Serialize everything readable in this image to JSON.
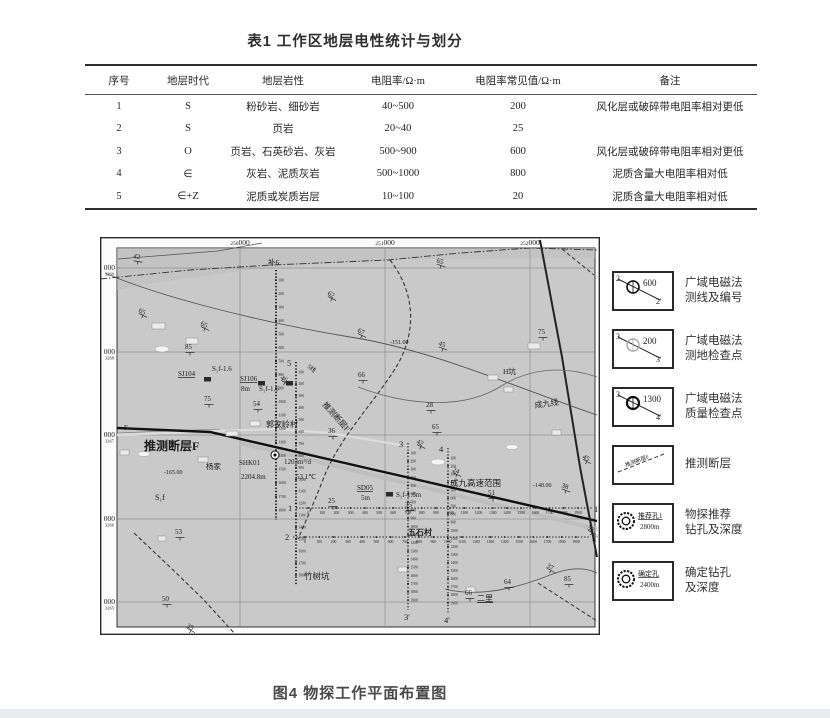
{
  "table": {
    "title": "表1 工作区地层电性统计与划分",
    "headers": [
      "序号",
      "地层时代",
      "地层岩性",
      "电阻率/Ω·m",
      "电阻率常见值/Ω·m",
      "备注"
    ],
    "col_widths": [
      68,
      70,
      120,
      110,
      130,
      174
    ],
    "rows": [
      [
        "1",
        "S",
        "粉砂岩、细砂岩",
        "40~500",
        "200",
        "风化层或破碎带电阻率相对更低"
      ],
      [
        "2",
        "S",
        "页岩",
        "20~40",
        "25",
        ""
      ],
      [
        "3",
        "O",
        "页岩、石英砂岩、灰岩",
        "500~900",
        "600",
        "风化层或破碎带电阻率相对更低"
      ],
      [
        "4",
        "∈",
        "灰岩、泥质灰岩",
        "500~1000",
        "800",
        "泥质含量大电阻率相对低"
      ],
      [
        "5",
        "∈+Z",
        "泥质或炭质岩层",
        "10~100",
        "20",
        "泥质含量大电阻率相对低"
      ]
    ]
  },
  "figure": {
    "caption": "图4 物探工作平面布置图",
    "map": {
      "bg": "#c9c9c9",
      "frame_color": "#2b2b2b",
      "eastings": [
        {
          "small": "250",
          "big": "000",
          "x": 140
        },
        {
          "small": "251",
          "big": "000",
          "x": 285
        },
        {
          "small": "252",
          "big": "000",
          "x": 430
        }
      ],
      "northings": [
        {
          "big": "000",
          "small": "3269",
          "y": 31
        },
        {
          "big": "000",
          "small": "3268",
          "y": 115
        },
        {
          "big": "000",
          "small": "3267",
          "y": 198
        },
        {
          "big": "000",
          "small": "3266",
          "y": 282
        },
        {
          "big": "000",
          "small": "3265",
          "y": 365
        }
      ],
      "polygons": [
        {
          "pts": "17,11 495,11 495,21 300,22 170,30 60,45 17,53",
          "f": "#bdbdbd",
          "o": 0.55
        }
      ],
      "paths": [
        {
          "d": "M140,206 L497,292",
          "w": 4,
          "c": "#bcbcbc",
          "o": 0.85
        },
        {
          "d": "M17,198 L120,194 L175,192 L230,196 L300,208",
          "w": 2.2,
          "c": "#dcdcdc"
        },
        {
          "d": "M17,196 L120,192",
          "w": 0.6,
          "c": "#777"
        },
        {
          "d": "M17,191 L110,195 L497,284",
          "w": 2.4,
          "c": "#111"
        },
        {
          "d": "M440,3 L462,120 L480,230 L497,320",
          "w": 2,
          "c": "#222"
        },
        {
          "d": "M5,36 C60,60 160,85 250,100 C330,112 420,152 497,178",
          "w": 0.9,
          "c": "#555"
        },
        {
          "d": "M18,22 L118,14 L162,6",
          "w": 0.8,
          "c": "#555"
        },
        {
          "d": "M0,42 L90,33 L172,28 L288,23 L360,16 L430,11 L497,13",
          "w": 0.9,
          "c": "#333",
          "da": "7 2 1.5 2"
        },
        {
          "d": "M290,23 C315,55 318,95 295,132 C272,168 240,200 224,240 C214,266 204,288 198,302",
          "w": 1.1,
          "c": "#333",
          "da": "4 2.5"
        },
        {
          "d": "M34,296 L70,330 L103,362 L135,397",
          "w": 1.1,
          "c": "#333",
          "da": "4 2.5"
        },
        {
          "d": "M462,12 L494,38",
          "w": 1,
          "c": "#333",
          "da": "4 2.5"
        },
        {
          "d": "M438,346 L497,384",
          "w": 1,
          "c": "#333",
          "da": "4 2.5"
        },
        {
          "d": "M258,150 C300,166 360,176 403,148 C430,132 462,128 497,140",
          "w": 0.8,
          "c": "#666"
        },
        {
          "d": "M345,352 C380,361 420,350 450,338 C470,330 485,330 497,336",
          "w": 0.9,
          "c": "#555"
        }
      ],
      "survey_lines": [
        {
          "dir": "v",
          "name": "",
          "name2": "",
          "x": 176,
          "y0": 33,
          "y1": 283,
          "stations": [
            100,
            1800,
            100
          ],
          "w": 1.8
        },
        {
          "dir": "v",
          "name": "5",
          "name2": "",
          "x": 196,
          "y0": 125,
          "y1": 348,
          "stations": [
            100,
            1800,
            100
          ],
          "w": 1.6
        },
        {
          "dir": "v",
          "name": "3",
          "name2": "3'",
          "x": 308,
          "y0": 206,
          "y1": 373,
          "stations": [
            100,
            1900,
            100
          ],
          "w": 1.1
        },
        {
          "dir": "v",
          "name": "4",
          "name2": "4'",
          "x": 348,
          "y0": 211,
          "y1": 376,
          "stations": [
            100,
            1900,
            100
          ],
          "w": 1.1
        },
        {
          "dir": "h",
          "name": "1",
          "name2": "1'",
          "y": 271,
          "x0": 196,
          "x1": 492,
          "stations": [
            0,
            1900,
            100
          ],
          "w": 1.1
        },
        {
          "dir": "h",
          "name": "2",
          "name2": "2'",
          "y": 300,
          "x0": 193,
          "x1": 490,
          "stations": [
            0,
            1900,
            100
          ],
          "w": 1.1
        }
      ],
      "labels": [
        {
          "t": "42",
          "x": 33,
          "y": 21,
          "dip": 1,
          "rot": 10
        },
        {
          "t": "65",
          "x": 38,
          "y": 75,
          "dip": 1,
          "rot": 25
        },
        {
          "t": "65",
          "x": 100,
          "y": 88,
          "dip": 1,
          "rot": 25
        },
        {
          "t": "85",
          "x": 85,
          "y": 112,
          "dip": 1,
          "rot": 0
        },
        {
          "t": "62",
          "x": 227,
          "y": 58,
          "dip": 1,
          "rot": 25
        },
        {
          "t": "补6",
          "x": 168,
          "y": 28,
          "s": 7.5
        },
        {
          "t": "65",
          "x": 336,
          "y": 25,
          "dip": 1,
          "rot": 20
        },
        {
          "t": "67",
          "x": 257,
          "y": 95,
          "dip": 1,
          "rot": 25
        },
        {
          "t": "-151.00",
          "x": 290,
          "y": 107,
          "s": 6
        },
        {
          "t": "45",
          "x": 338,
          "y": 108,
          "dip": 1,
          "rot": 20
        },
        {
          "t": "66",
          "x": 258,
          "y": 140,
          "dip": 1,
          "rot": 0
        },
        {
          "t": "28",
          "x": 326,
          "y": 170,
          "dip": 1,
          "rot": 0
        },
        {
          "t": "65",
          "x": 332,
          "y": 192,
          "dip": 1,
          "rot": 0
        },
        {
          "t": "36",
          "x": 228,
          "y": 196,
          "dip": 1,
          "rot": 0
        },
        {
          "t": "75",
          "x": 438,
          "y": 97,
          "dip": 1,
          "rot": 0
        },
        {
          "t": "H坑",
          "x": 403,
          "y": 137,
          "s": 7.5
        },
        {
          "t": "成九线",
          "x": 435,
          "y": 171,
          "s": 8,
          "rot": -8
        },
        {
          "t": "45",
          "x": 482,
          "y": 221,
          "dip": 1,
          "rot": 30
        },
        {
          "t": "SJ104",
          "x": 78,
          "y": 139,
          "u": 1
        },
        {
          "t": "S₁f-1.6",
          "x": 112,
          "y": 134
        },
        {
          "t": "SJ106",
          "x": 140,
          "y": 144,
          "u": 1
        },
        {
          "t": "8m",
          "x": 141,
          "y": 154
        },
        {
          "t": "S₁f-1.6",
          "x": 159,
          "y": 154
        },
        {
          "t": "46",
          "x": 180,
          "y": 142,
          "dip": 1,
          "rot": 30
        },
        {
          "t": "75",
          "x": 104,
          "y": 164,
          "dip": 1,
          "rot": 0
        },
        {
          "t": "54",
          "x": 153,
          "y": 169,
          "dip": 1,
          "rot": 0
        },
        {
          "t": "郭家岭村",
          "x": 166,
          "y": 190,
          "s": 8
        },
        {
          "t": "F",
          "x": 24,
          "y": 193,
          "s": 7
        },
        {
          "t": "推测断层F",
          "x": 44,
          "y": 213,
          "s": 12,
          "b": 1
        },
        {
          "t": "杨家",
          "x": 106,
          "y": 232,
          "s": 7.5
        },
        {
          "t": "SHK01",
          "x": 139,
          "y": 228
        },
        {
          "t": "1203m³/d",
          "x": 184,
          "y": 227
        },
        {
          "t": "2204.8m",
          "x": 141,
          "y": 242
        },
        {
          "t": "53.1℃",
          "x": 196,
          "y": 242
        },
        {
          "t": "-165.00",
          "x": 64,
          "y": 237,
          "s": 6
        },
        {
          "t": "S₁f",
          "x": 55,
          "y": 263,
          "s": 8
        },
        {
          "t": "53",
          "x": 75,
          "y": 297,
          "dip": 1,
          "rot": 0
        },
        {
          "t": "SD05",
          "x": 257,
          "y": 253,
          "u": 1
        },
        {
          "t": "5m",
          "x": 261,
          "y": 263
        },
        {
          "t": "S₁f-1.6m",
          "x": 296,
          "y": 260
        },
        {
          "t": "25",
          "x": 228,
          "y": 266,
          "dip": 1,
          "rot": 0
        },
        {
          "t": "35",
          "x": 305,
          "y": 270,
          "dip": 1,
          "rot": 0
        },
        {
          "t": "成九高速范围",
          "x": 350,
          "y": 249,
          "s": 8.5
        },
        {
          "t": "51",
          "x": 388,
          "y": 258,
          "dip": 1,
          "rot": 0
        },
        {
          "t": "-148.00",
          "x": 433,
          "y": 250,
          "s": 6
        },
        {
          "t": "38",
          "x": 461,
          "y": 250,
          "dip": 1,
          "rot": 20
        },
        {
          "t": "42",
          "x": 316,
          "y": 206,
          "dip": 1,
          "rot": 25
        },
        {
          "t": "24",
          "x": 352,
          "y": 234,
          "dip": 1,
          "rot": 25
        },
        {
          "t": "五石村",
          "x": 308,
          "y": 298,
          "s": 8,
          "b": 1
        },
        {
          "t": "竹树坑",
          "x": 204,
          "y": 342,
          "s": 8.5
        },
        {
          "t": "50",
          "x": 62,
          "y": 364,
          "dip": 1,
          "rot": 0
        },
        {
          "t": "35",
          "x": 86,
          "y": 390,
          "dip": 1,
          "rot": 30
        },
        {
          "t": "二里",
          "x": 377,
          "y": 364,
          "s": 8,
          "u": 1
        },
        {
          "t": "66",
          "x": 365,
          "y": 358,
          "dip": 1,
          "rot": 0
        },
        {
          "t": "64",
          "x": 404,
          "y": 347,
          "dip": 1,
          "rot": 0
        },
        {
          "t": "85",
          "x": 464,
          "y": 344,
          "dip": 1,
          "rot": 0
        },
        {
          "t": "37",
          "x": 446,
          "y": 330,
          "dip": 1,
          "rot": 30
        },
        {
          "t": "52",
          "x": 487,
          "y": 292,
          "dip": 1,
          "rot": 30
        },
        {
          "t": "5线",
          "x": 207,
          "y": 130,
          "s": 6,
          "rot": 40
        },
        {
          "t": "推测断层F",
          "x": 222,
          "y": 168,
          "s": 8,
          "rot": 48
        }
      ],
      "squares": [
        [
          104,
          140
        ],
        [
          158,
          144
        ],
        [
          186,
          144
        ],
        [
          286,
          255
        ]
      ],
      "wells": [
        [
          175,
          218
        ]
      ],
      "buildings": [
        [
          52,
          86,
          13,
          6
        ],
        [
          86,
          101,
          12,
          6
        ],
        [
          126,
          194,
          12,
          5
        ],
        [
          150,
          184,
          10,
          5
        ],
        [
          98,
          220,
          10,
          5
        ],
        [
          388,
          138,
          10,
          5
        ],
        [
          404,
          150,
          9,
          5
        ],
        [
          366,
          350,
          9,
          5
        ],
        [
          298,
          330,
          9,
          5
        ],
        [
          428,
          106,
          12,
          6
        ],
        [
          452,
          193,
          9,
          5
        ],
        [
          58,
          299,
          8,
          5
        ],
        [
          20,
          213,
          9,
          5
        ]
      ],
      "ponds": [
        [
          62,
          112,
          7,
          3
        ],
        [
          44,
          217,
          6,
          2.5
        ],
        [
          338,
          225,
          7,
          3
        ],
        [
          412,
          210,
          6,
          2.5
        ]
      ]
    },
    "legend": {
      "items": [
        {
          "type": "line",
          "circle": "dark",
          "n1": "2",
          "n2": "2'",
          "val": "600",
          "l1": "广域电磁法",
          "l2": "测线及编号"
        },
        {
          "type": "line",
          "circle": "light",
          "n1": "3",
          "n2": "3'",
          "val": "200",
          "l1": "广域电磁法",
          "l2": "测地检查点"
        },
        {
          "type": "line",
          "circle": "bold",
          "n1": "3",
          "n2": "4'",
          "val": "1300",
          "l1": "广域电磁法",
          "l2": "质量检查点"
        },
        {
          "type": "fault",
          "text": "推测断层F",
          "l1": "推测断层",
          "l2": ""
        },
        {
          "type": "hole",
          "name": "推荐孔1",
          "depth": "2800m",
          "l1": "物探推荐",
          "l2": "钻孔及深度"
        },
        {
          "type": "hole",
          "name": "确定孔",
          "depth": "2400m",
          "l1": "确定钻孔",
          "l2": "及深度"
        }
      ]
    }
  }
}
